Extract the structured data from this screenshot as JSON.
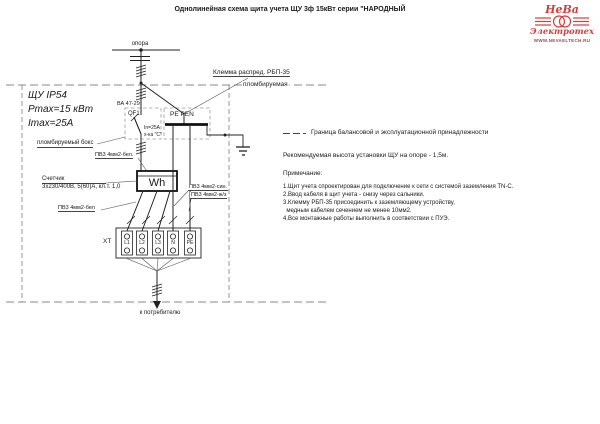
{
  "title": "Однолинейная схема щита учета ЩУ 3ф 15кВт серии \"НАРОДНЫЙ",
  "logo": {
    "brand_top": "НеВа",
    "brand_bottom": "Электротех",
    "url": "WWW.NEVAELTECH.RU",
    "brand_color": "#cf4040"
  },
  "diagram": {
    "pole_label": "опора",
    "clamp_label_line1": "Клемма распред. РБП-35",
    "clamp_label_line2": "пломбируемая",
    "enclosure_title": "ЩУ IP54",
    "enclosure_pmax": "Pmax=15 кВт",
    "enclosure_imax": "Imax=25A",
    "sealed_box_label": "пломбируемый бокс",
    "breaker_model": "ВА 47-29",
    "breaker_ref": "QF1",
    "breaker_current": "In=25A",
    "breaker_curve": "х-ка \"С\"",
    "pen_bus_label": "PE PEN",
    "wire_label_white_top": "ПВ3 4мм2-бел.",
    "meter_caption": "Счетчик",
    "meter_specs": "3х230/400В, 5(60)А, кл.т. 1,0",
    "meter_symbol": "Wh",
    "wire_label_white_bottom": "ПВ3 4мм2-бел",
    "wire_label_blue": "ПВ3 4мм2-син.",
    "wire_label_yellow_green": "ПВ3 4мм2-ж/з",
    "terminal_block_ref": "XT",
    "terminals": [
      "L1",
      "L2",
      "L3",
      "N",
      "PE"
    ],
    "consumer_label": "к потребителю"
  },
  "legend": {
    "boundary_label": "Граница балансовой и эксплуатационной принадлежности"
  },
  "annotations": {
    "mount_height": "Рекомендуемая высота установки ЩУ на опоре - 1,5м.",
    "notes_heading": "Примечание:",
    "notes": [
      "1.Щит учета спроектирован для подключение к сети с системой заземления TN-C.",
      "2.Ввод кабеля в щит учета - снизу через сальники.",
      "3.Клемму РБП-35 присоединить к заземляющему устройству,",
      "  медным кабелем сечением не менее 10мм2.",
      "4.Все монтажные работы выполнить в соответствии с ПУЭ."
    ]
  }
}
